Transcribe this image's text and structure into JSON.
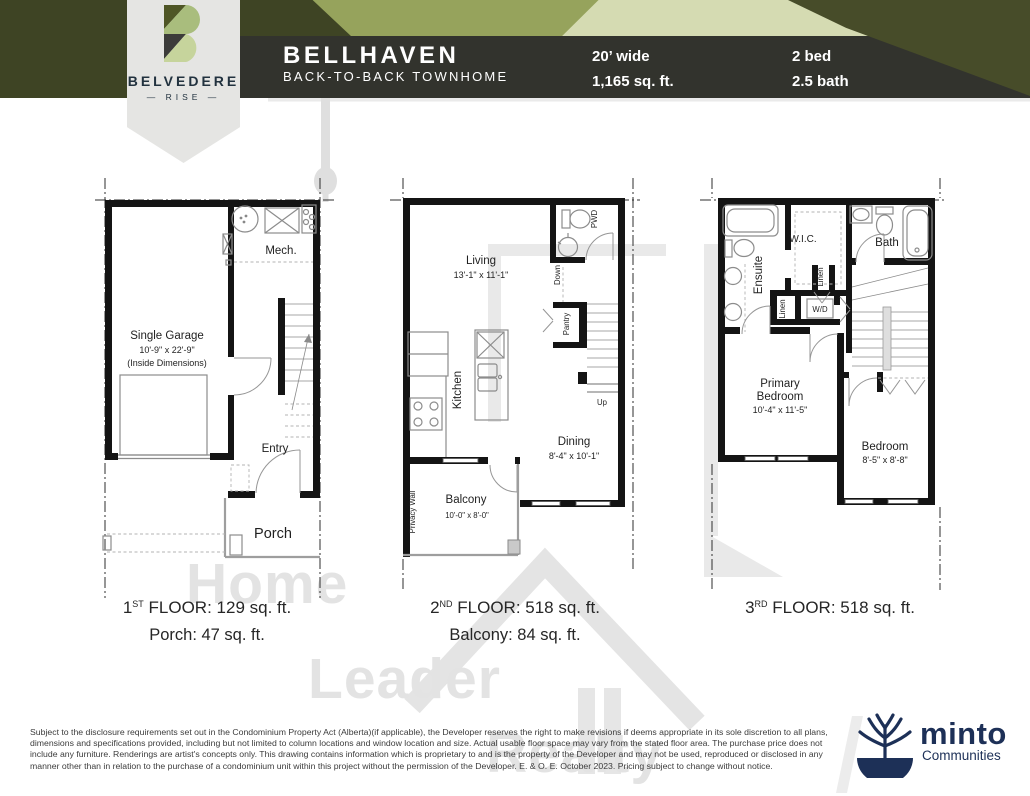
{
  "header": {
    "title": "BELLHAVEN",
    "subtitle": "BACK-TO-BACK TOWNHOME",
    "stat_width": "20’ wide",
    "stat_area": "1,165 sq. ft.",
    "stat_bed": "2 bed",
    "stat_bath": "2.5 bath"
  },
  "brand": {
    "name": "BELVEDERE",
    "sub": "— RISE —"
  },
  "watermark": {
    "line1": "Home",
    "line2": "Leader",
    "line3": "Realty"
  },
  "floor1": {
    "mech": "Mech.",
    "garage1": "Single Garage",
    "garage2": "10'-9\" x 22'-9\"",
    "garage3": "(Inside Dimensions)",
    "entry": "Entry",
    "porch": "Porch",
    "label_num": "1",
    "label_ord": "ST",
    "label_rest": " FLOOR: 129 sq. ft.",
    "sublabel": "Porch: 47 sq. ft."
  },
  "floor2": {
    "living": "Living",
    "living_dims": "13'-1\" x 11'-1\"",
    "pwd": "PWD",
    "down": "Down",
    "pantry": "Pantry",
    "kitchen": "Kitchen",
    "dining": "Dining",
    "dining_dims": "8'-4\" x 10'-1\"",
    "up": "Up",
    "balcony": "Balcony",
    "balcony_dims": "10'-0\" x 8'-0\"",
    "privacy": "Privacy Wall",
    "label_num": "2",
    "label_ord": "ND",
    "label_rest": " FLOOR: 518 sq. ft.",
    "sublabel": "Balcony: 84 sq. ft."
  },
  "floor3": {
    "ensuite": "Ensuite",
    "wic": "W.I.C.",
    "bath": "Bath",
    "linen1": "Linen",
    "linen2": "Linen",
    "wd": "W/D",
    "primary1": "Primary",
    "primary2": "Bedroom",
    "primary_dims": "10'-4\" x 11'-5\"",
    "bedroom": "Bedroom",
    "bedroom_dims": "8'-5\" x 8'-8\"",
    "label_num": "3",
    "label_ord": "RD",
    "label_rest": " FLOOR: 518 sq. ft."
  },
  "disclaimer": "Subject to the disclosure requirements set out in the Condominium Property Act (Alberta)(if applicable), the Developer reserves the right to make revisions if deems appropriate in its sole discretion to all plans, dimensions and specifications provided, including but not limited to column locations and window location and size. Actual usable floor space may vary from the stated floor area. The purchase price does not include any furniture. Renderings are artist's concepts only. This drawing contains information which is proprietary to and is the property of the Developer and may not be used, reproduced or disclosed in any manner other than in relation to the purchase of a condominium unit within this project without the permission of the Developer. E. & O. E. October 2023. Pricing subject to change without notice.",
  "developer": {
    "name": "minto",
    "tagline": "Communities"
  },
  "colors": {
    "dark_olive": "#3e4424",
    "medium_green": "#96a35c",
    "pale_sage": "#d5dbb2",
    "charcoal": "#32332d",
    "shield_gray": "#e5e5e3",
    "brand_navy": "#22323f",
    "minto_navy": "#1d3057",
    "watermark_gray": "#e3e3e3"
  }
}
